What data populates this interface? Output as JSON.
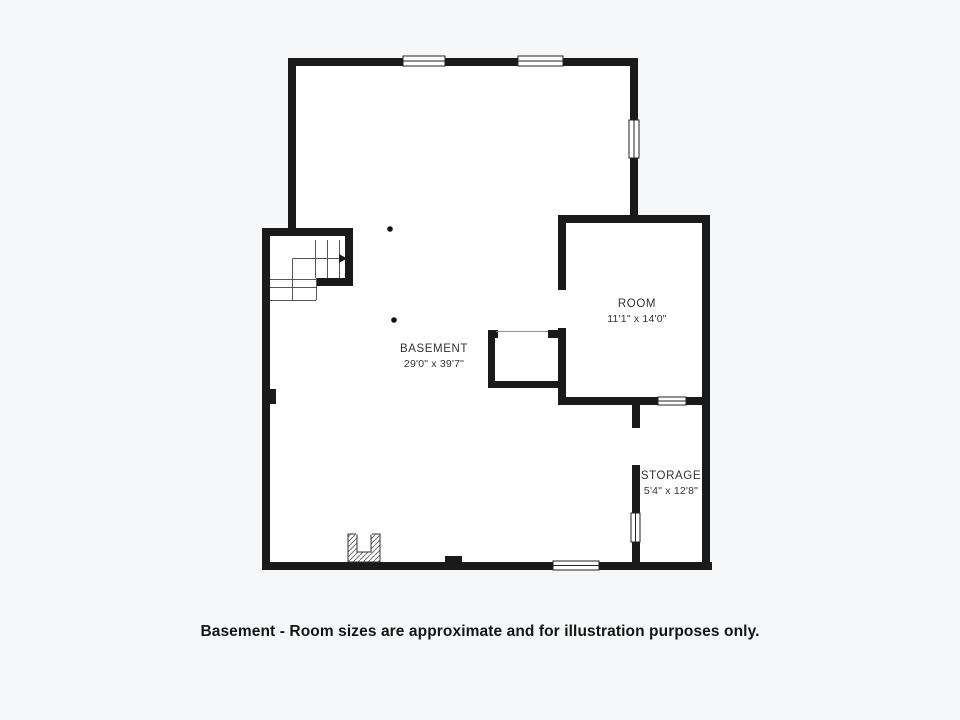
{
  "floorplan": {
    "caption": "Basement - Room sizes are approximate and for illustration purposes only.",
    "rooms": {
      "basement": {
        "name": "BASEMENT",
        "dimensions": "29'0\" x 39'7\""
      },
      "room": {
        "name": "ROOM",
        "dimensions": "11'1\" x 14'0\""
      },
      "storage": {
        "name": "STORAGE",
        "dimensions": "5'4\" x 12'8\""
      }
    },
    "symbols": [
      "window",
      "door-opening",
      "staircase",
      "fireplace",
      "support-post"
    ],
    "colors": {
      "wall": "#1a1a1a",
      "background": "#f6f7f8",
      "floor": "#ffffff",
      "label_text": "#333333",
      "caption_text": "#141414"
    }
  }
}
